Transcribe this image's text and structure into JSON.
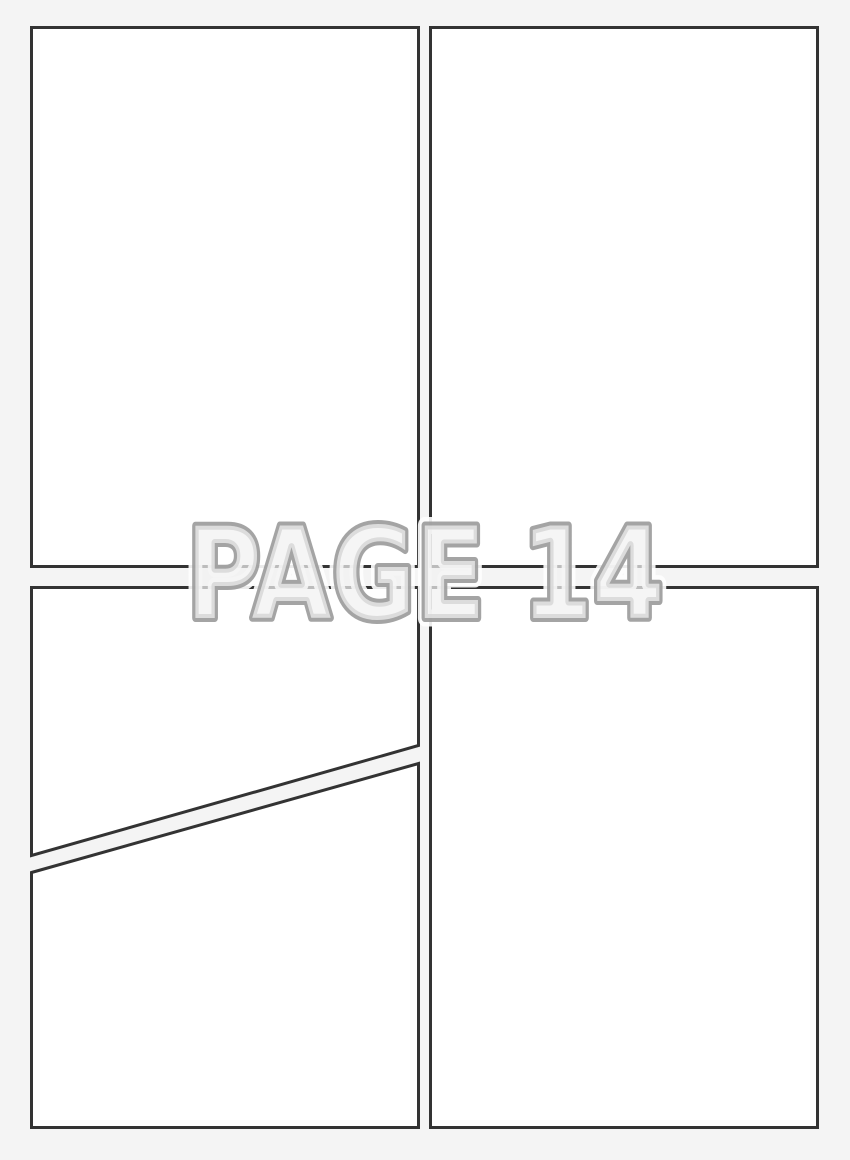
{
  "page": {
    "label": "PAGE 14",
    "background_color": "#f4f4f4",
    "panel_fill": "#ffffff",
    "panel_border_color": "#333333",
    "label_fill_color": "#f1f1f1",
    "label_outline_color": "#9b9b9b",
    "label_halo_color": "#ffffff",
    "panel_count": 5
  },
  "panels": [
    {
      "name": "top-left",
      "content": ""
    },
    {
      "name": "top-right",
      "content": ""
    },
    {
      "name": "bottom-left-upper",
      "content": ""
    },
    {
      "name": "bottom-left-lower",
      "content": ""
    },
    {
      "name": "bottom-right",
      "content": ""
    }
  ]
}
